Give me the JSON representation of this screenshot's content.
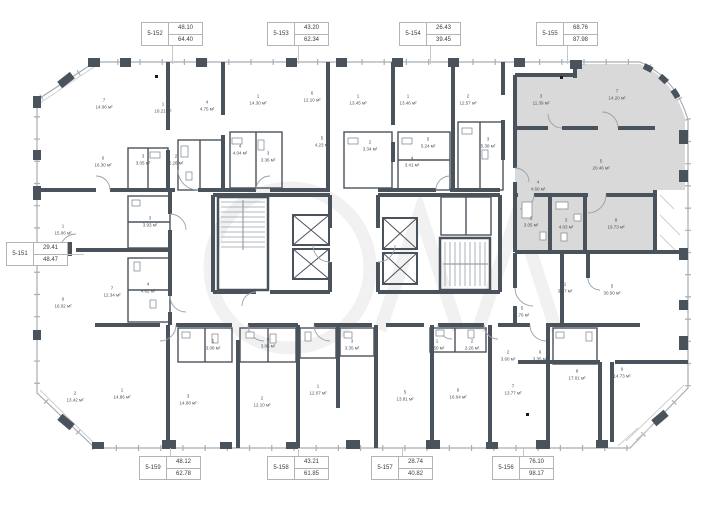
{
  "colors": {
    "wall": "#4a525b",
    "outline": "#a6adb4",
    "highlight_fill": "#d9d9d9",
    "label_border": "#b4b4b4",
    "leader": "#c6c6c6",
    "watermark": "#f1f1f1"
  },
  "highlighted_unit_id": "5-155",
  "area_unit": "м²",
  "unit_labels": [
    {
      "id": "5-152",
      "top": "48.10",
      "bottom": "64.40",
      "x": 141,
      "y": 22,
      "leader": {
        "dir": "v",
        "x": 172,
        "y": 46,
        "len": 18
      }
    },
    {
      "id": "5-153",
      "top": "43.20",
      "bottom": "62.34",
      "x": 267,
      "y": 22,
      "leader": {
        "dir": "v",
        "x": 298,
        "y": 46,
        "len": 18
      }
    },
    {
      "id": "5-154",
      "top": "26.43",
      "bottom": "39.45",
      "x": 399,
      "y": 22,
      "leader": {
        "dir": "v",
        "x": 430,
        "y": 46,
        "len": 18
      }
    },
    {
      "id": "5-155",
      "top": "68.76",
      "bottom": "87.98",
      "x": 536,
      "y": 22,
      "leader": {
        "dir": "v",
        "x": 567,
        "y": 46,
        "len": 18
      }
    },
    {
      "id": "5-151",
      "top": "29.41",
      "bottom": "48.47",
      "x": 6,
      "y": 242,
      "leader": {
        "dir": "h",
        "x": 68,
        "y": 254,
        "len": 16
      }
    },
    {
      "id": "5-159",
      "top": "48.12",
      "bottom": "62.78",
      "x": 139,
      "y": 456,
      "leader": {
        "dir": "v",
        "x": 170,
        "y": 448,
        "len": 8
      }
    },
    {
      "id": "5-158",
      "top": "43.21",
      "bottom": "61.85",
      "x": 267,
      "y": 456,
      "leader": {
        "dir": "v",
        "x": 298,
        "y": 448,
        "len": 8
      }
    },
    {
      "id": "5-157",
      "top": "28.74",
      "bottom": "40.82",
      "x": 371,
      "y": 456,
      "leader": {
        "dir": "v",
        "x": 402,
        "y": 448,
        "len": 8
      }
    },
    {
      "id": "5-156",
      "top": "76.10",
      "bottom": "98.17",
      "x": 492,
      "y": 456,
      "leader": {
        "dir": "v",
        "x": 523,
        "y": 448,
        "len": 8
      }
    }
  ],
  "rooms": [
    {
      "n": "7",
      "a": "14.06 м²",
      "x": 104,
      "y": 104
    },
    {
      "n": "1",
      "a": "18.21 м²",
      "x": 163,
      "y": 108
    },
    {
      "n": "4",
      "a": "4.75 м²",
      "x": 207,
      "y": 106
    },
    {
      "n": "3",
      "a": "3.05 м²",
      "x": 143,
      "y": 160
    },
    {
      "n": "2",
      "a": "2.28 м²",
      "x": 176,
      "y": 160
    },
    {
      "n": "6",
      "a": "16.30 м²",
      "x": 103,
      "y": 162
    },
    {
      "n": "1",
      "a": "14.30 м²",
      "x": 258,
      "y": 100
    },
    {
      "n": "6",
      "a": "12.10 м²",
      "x": 312,
      "y": 97
    },
    {
      "n": "4",
      "a": "4.04 м²",
      "x": 240,
      "y": 150
    },
    {
      "n": "3",
      "a": "3.36 м²",
      "x": 268,
      "y": 157
    },
    {
      "n": "5",
      "a": "4.23 м²",
      "x": 322,
      "y": 142
    },
    {
      "n": "1",
      "a": "13.45 м²",
      "x": 358,
      "y": 100
    },
    {
      "n": "2",
      "a": "3.34 м²",
      "x": 370,
      "y": 146
    },
    {
      "n": "1",
      "a": "13.46 м²",
      "x": 408,
      "y": 100
    },
    {
      "n": "5",
      "a": "5.24 м²",
      "x": 428,
      "y": 143
    },
    {
      "n": "4",
      "a": "3.41 м²",
      "x": 412,
      "y": 162
    },
    {
      "n": "2",
      "a": "12.57 м²",
      "x": 468,
      "y": 100
    },
    {
      "n": "3",
      "a": "5.38 м²",
      "x": 488,
      "y": 143
    },
    {
      "n": "3",
      "a": "11.39 м²",
      "x": 541,
      "y": 100
    },
    {
      "n": "7",
      "a": "14.20 м²",
      "x": 617,
      "y": 95
    },
    {
      "n": "5",
      "a": "20.46 м²",
      "x": 601,
      "y": 165
    },
    {
      "n": "4",
      "a": "4.60 м²",
      "x": 538,
      "y": 186
    },
    {
      "n": "2",
      "a": "3.05 м²",
      "x": 531,
      "y": 222
    },
    {
      "n": "3",
      "a": "4.03 м²",
      "x": 566,
      "y": 224
    },
    {
      "n": "8",
      "a": "19.73 м²",
      "x": 616,
      "y": 224
    },
    {
      "n": "1",
      "a": "15.06 м²",
      "x": 63,
      "y": 230
    },
    {
      "n": "7",
      "a": "12.34 м²",
      "x": 112,
      "y": 292
    },
    {
      "n": "4",
      "a": "4.62 м²",
      "x": 148,
      "y": 288
    },
    {
      "n": "6",
      "a": "16.02 м²",
      "x": 63,
      "y": 303
    },
    {
      "n": "3",
      "a": "3.93 м²",
      "x": 150,
      "y": 222
    },
    {
      "n": "2",
      "a": "13.42 м²",
      "x": 75,
      "y": 397
    },
    {
      "n": "1",
      "a": "14.86 м²",
      "x": 122,
      "y": 394
    },
    {
      "n": "3",
      "a": "14.08 м²",
      "x": 188,
      "y": 400
    },
    {
      "n": "2",
      "a": "12.10 м²",
      "x": 262,
      "y": 402
    },
    {
      "n": "1",
      "a": "12.07 м²",
      "x": 318,
      "y": 390
    },
    {
      "n": "5",
      "a": "3.08 м²",
      "x": 213,
      "y": 345
    },
    {
      "n": "4",
      "a": "3.86 м²",
      "x": 268,
      "y": 343
    },
    {
      "n": "3",
      "a": "3.35 м²",
      "x": 352,
      "y": 345
    },
    {
      "n": "5",
      "a": "13.81 м²",
      "x": 405,
      "y": 396
    },
    {
      "n": "5",
      "a": "5.76 м²",
      "x": 522,
      "y": 312
    },
    {
      "n": "1",
      "a": "2.50 м²",
      "x": 437,
      "y": 345
    },
    {
      "n": "2",
      "a": "2.26 м²",
      "x": 472,
      "y": 345
    },
    {
      "n": "2",
      "a": "3.60 м²",
      "x": 508,
      "y": 356
    },
    {
      "n": "6",
      "a": "3.35 м²",
      "x": 540,
      "y": 356
    },
    {
      "n": "1",
      "a": "3.97 м²",
      "x": 565,
      "y": 288
    },
    {
      "n": "5",
      "a": "30.50 м²",
      "x": 612,
      "y": 290
    },
    {
      "n": "8",
      "a": "17.01 м²",
      "x": 577,
      "y": 375
    },
    {
      "n": "9",
      "a": "14.73 м²",
      "x": 622,
      "y": 373
    },
    {
      "n": "7",
      "a": "13.77 м²",
      "x": 513,
      "y": 390
    },
    {
      "n": "6",
      "a": "16.04 м²",
      "x": 458,
      "y": 394
    }
  ]
}
